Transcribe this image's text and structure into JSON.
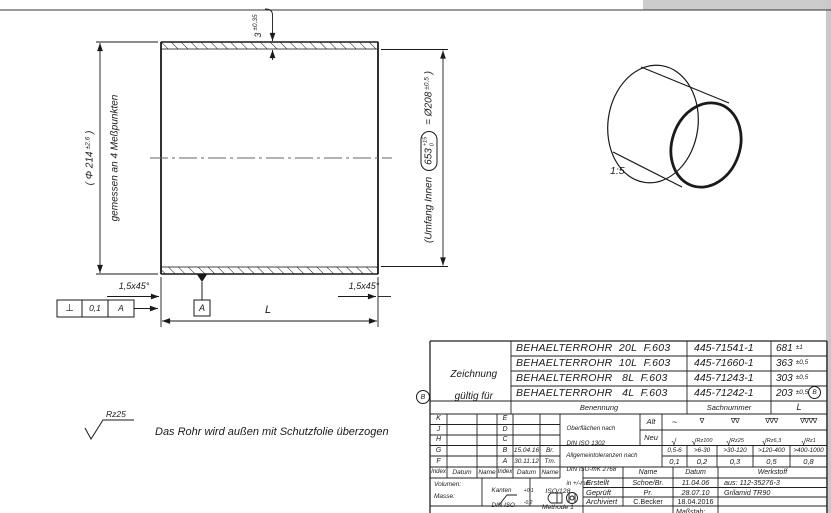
{
  "drawing": {
    "top_dim": {
      "value": "3",
      "tol": "±0,35"
    },
    "outer_dia": {
      "text": "( Φ 214",
      "tol": "±2,6",
      "close": " )"
    },
    "outer_dia_note": "gemessen an 4 Meßpunkten",
    "inner_dim": {
      "label": "(Umfang Innen",
      "value": "653",
      "tol_top": "+15",
      "tol_bot": "0",
      "equals": "= Ø208",
      "equals_tol": "±0,5",
      "close": " )"
    },
    "length_label": "L",
    "chamfer_left": "1,5x45°",
    "chamfer_right": "1,5x45°",
    "datum_label": "A",
    "fcf": {
      "symbol": "⊥",
      "tolerance": "0,1",
      "datum": "A"
    },
    "pictorial_scale": "1:5",
    "roughness": "Rz25",
    "note": "Das Rohr wird außen mit Schutzfolie überzogen"
  },
  "title_block": {
    "rev_marker": "B",
    "valid_for_1": "Zeichnung",
    "valid_for_2": "gültig für",
    "variants": [
      {
        "name": "BEHAELTERROHR  20L  F.603",
        "number": "445-71541-1",
        "l": "681",
        "l_tol": "±1"
      },
      {
        "name": "BEHAELTERROHR  10L  F.603",
        "number": "445-71660-1",
        "l": "363",
        "l_tol": "±0,5"
      },
      {
        "name": "BEHAELTERROHR   8L  F.603",
        "number": "445-71243-1",
        "l": "303",
        "l_tol": "±0,5"
      },
      {
        "name": "BEHAELTERROHR   4L  F.603",
        "number": "445-71242-1",
        "l": "203",
        "l_tol": "±0,5"
      }
    ],
    "col_headers": {
      "name": "Benennung",
      "number": "Sachnummer",
      "length": "L"
    },
    "index_header": [
      "Index",
      "Datum",
      "Name",
      "Index",
      "Datum",
      "Name"
    ],
    "index_rows": [
      {
        "l": "K",
        "r": "E",
        "date": "",
        "name": ""
      },
      {
        "l": "J",
        "r": "D",
        "date": "",
        "name": ""
      },
      {
        "l": "H",
        "r": "C",
        "date": "",
        "name": ""
      },
      {
        "l": "G",
        "r": "B",
        "date": "15.04.16",
        "name": "Br."
      },
      {
        "l": "F",
        "r": "A",
        "date": "30.11.12",
        "name": "Tm."
      }
    ],
    "surface": {
      "title1": "Oberflächen nach",
      "title2": "DIN ISO 1302",
      "alt": "Alt",
      "neu": "Neu",
      "alt_symbols": [
        "~",
        "∇",
        "∇∇",
        "∇∇∇",
        "∇∇∇∇"
      ],
      "neu_checks": [
        "√",
        "√",
        "√",
        "√",
        "√"
      ],
      "neu_labels": [
        "",
        "Rz100",
        "Rz25",
        "Rz6,3",
        "Rz1"
      ]
    },
    "tolerances": {
      "title1": "Allgemeintoleranzen nach",
      "title2": "DIN ISO-mK 2768",
      "title3": "in +/-mm",
      "ranges": [
        "0,5-6",
        ">6-30",
        ">30-120",
        ">120-400",
        ">400-1000"
      ],
      "values": [
        "0,1",
        "0,2",
        "0,3",
        "0,5",
        "0,8"
      ]
    },
    "info": {
      "volumen": "Volumen:",
      "masse": "Masse:",
      "kanten1": "Kanten",
      "kanten2": "DIN ISO",
      "kanten3": "13715",
      "kanten_tol_top": "+0,1",
      "kanten_tol_bot": "-0,2",
      "iso1": "ISO/128",
      "iso2": "Methode 1"
    },
    "approval_headers": {
      "name": "Name",
      "date": "Datum",
      "material": "Werkstoff"
    },
    "approvals": [
      {
        "label": "Erstellt",
        "name": "Schoe/Br.",
        "date": "11.04.06",
        "info": "aus: 112-35276-3"
      },
      {
        "label": "Geprüft",
        "name": "Pr.",
        "date": "28.07.10",
        "info": "Grilamid TR90"
      },
      {
        "label": "Archiviert",
        "name": "C.Becker",
        "date": "18.04.2016",
        "info": ""
      }
    ],
    "partial_bottom": "Maßstab:"
  }
}
